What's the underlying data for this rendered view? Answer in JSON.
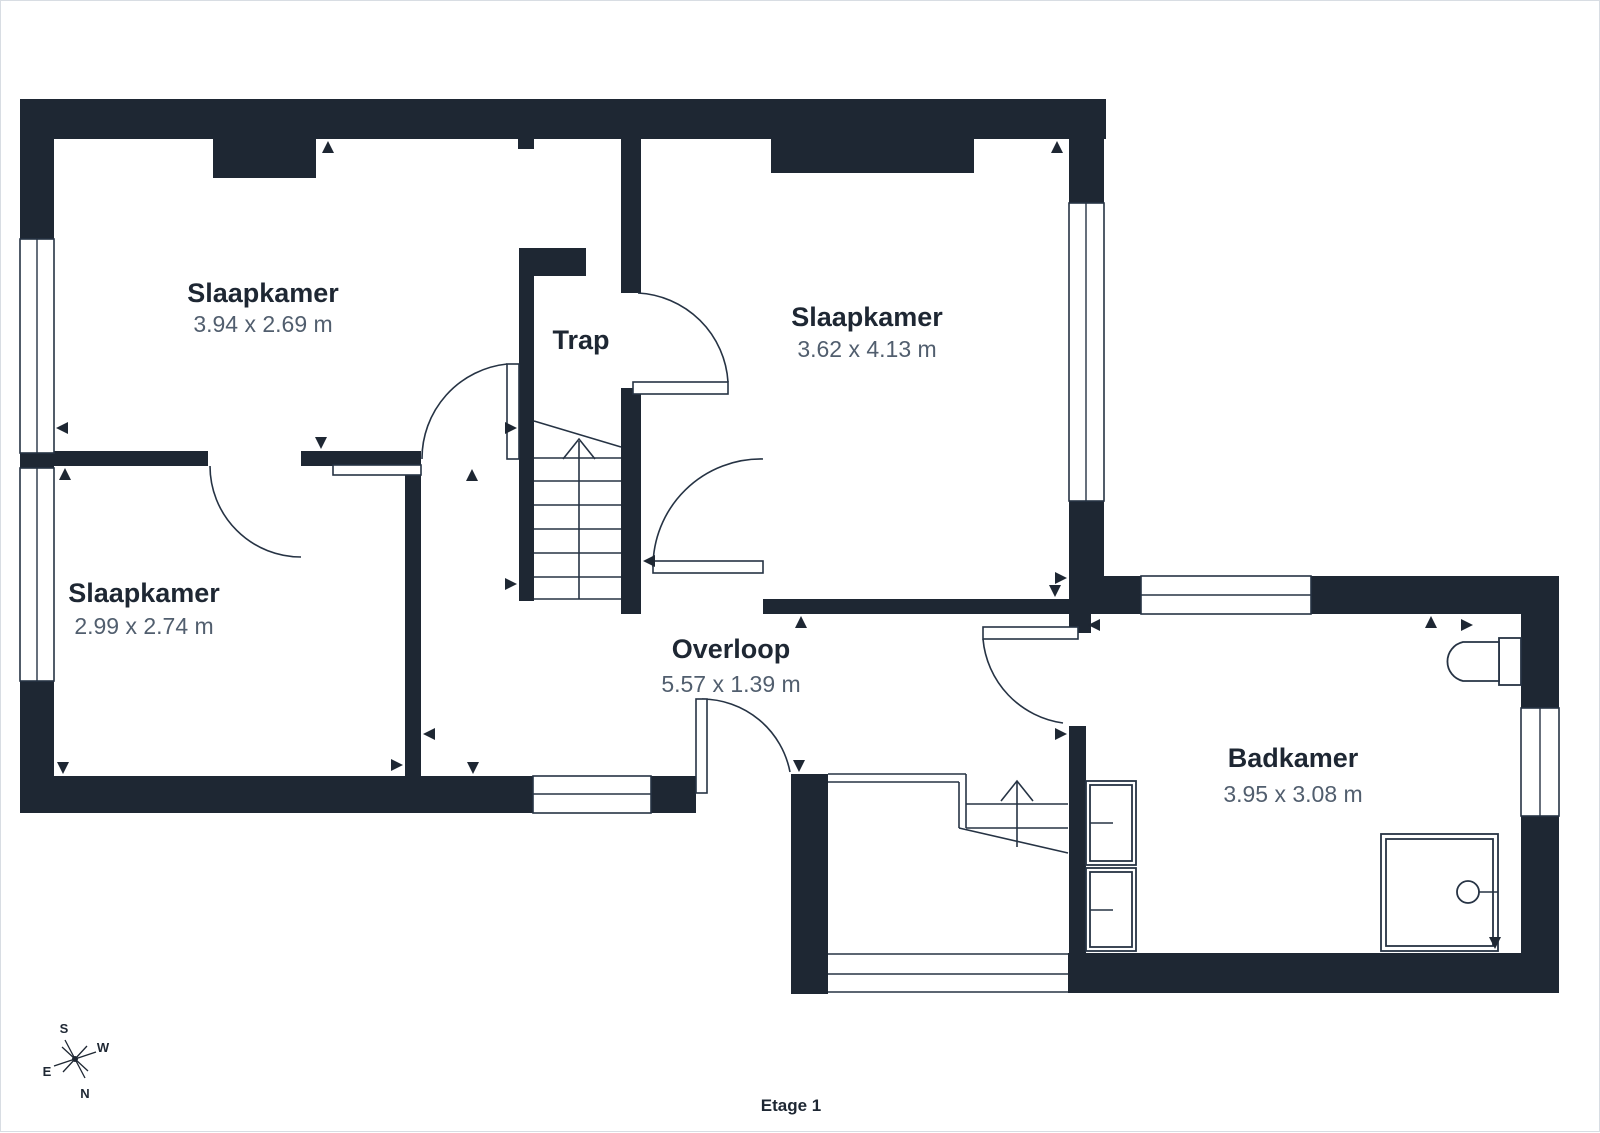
{
  "colors": {
    "wall": "#1e2733",
    "line": "#263344",
    "text_primary": "#1e2733",
    "text_secondary": "#515e6e",
    "background": "#ffffff",
    "page_border": "#d8dde3"
  },
  "floor": {
    "title": "Etage 1"
  },
  "rooms": [
    {
      "id": "slaapkamer-nw",
      "name": "Slaapkamer",
      "dims": "3.94 x 2.69 m"
    },
    {
      "id": "slaapkamer-ne",
      "name": "Slaapkamer",
      "dims": "3.62 x 4.13 m"
    },
    {
      "id": "slaapkamer-sw",
      "name": "Slaapkamer",
      "dims": "2.99 x 2.74 m"
    },
    {
      "id": "trap",
      "name": "Trap",
      "dims": ""
    },
    {
      "id": "overloop",
      "name": "Overloop",
      "dims": "5.57 x 1.39 m"
    },
    {
      "id": "badkamer",
      "name": "Badkamer",
      "dims": "3.95 x 3.08 m"
    }
  ],
  "compass": {
    "s": "S",
    "w": "W",
    "e": "E",
    "n": "N"
  }
}
